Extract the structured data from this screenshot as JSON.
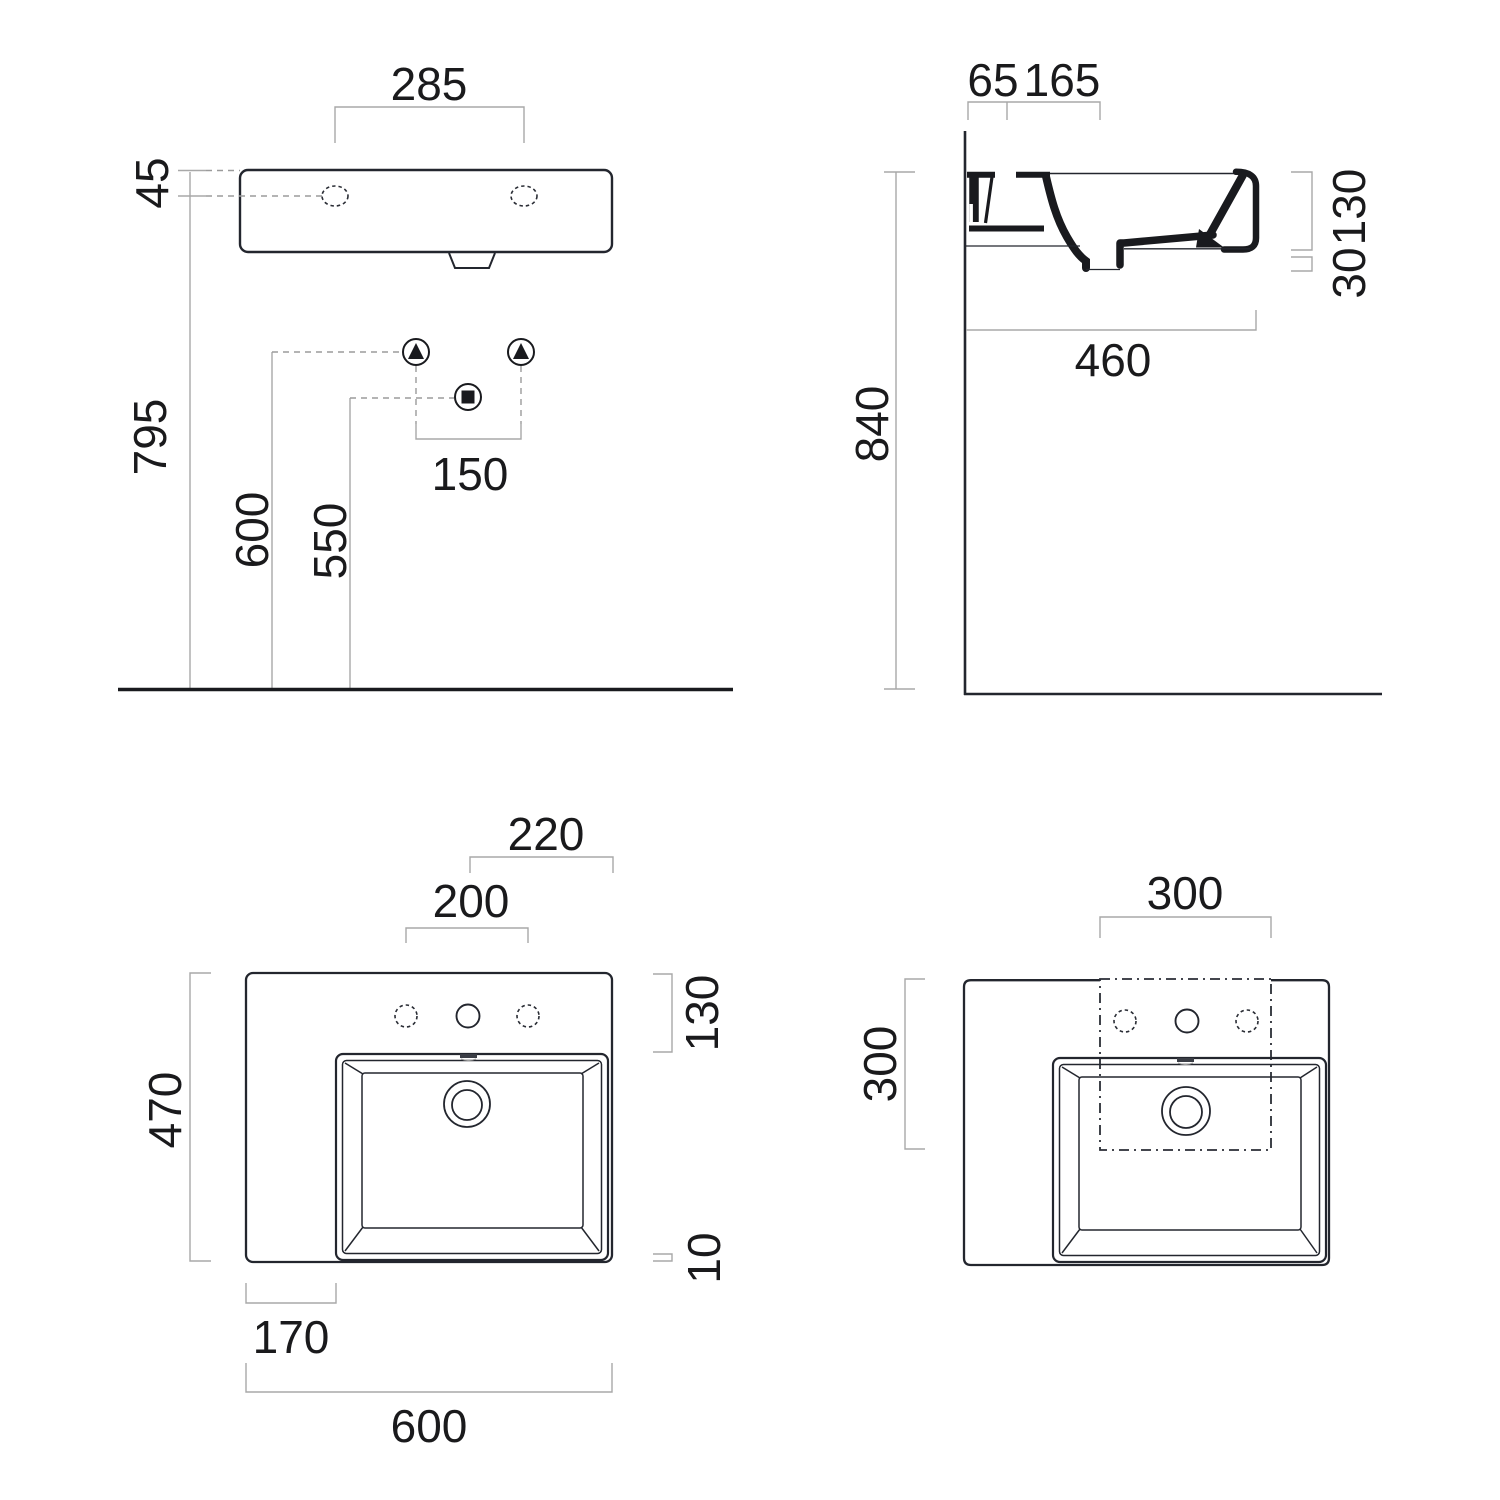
{
  "drawing": {
    "background": "#ffffff",
    "colors": {
      "object_line": "#23262e",
      "dimension_line": "#a8a8a8",
      "text": "#1a1a1c"
    },
    "views": {
      "front_elevation": {
        "dims": {
          "tap_centres": "285",
          "rim_to_tap": "45",
          "floor_to_rim": "795",
          "floor_to_supply": "600",
          "floor_to_waste": "550",
          "supply_centres": "150"
        }
      },
      "side_section": {
        "dims": {
          "wall_to_tap": "65",
          "tap_to_overflow": "165",
          "basin_height": "130",
          "outlet_drop": "30",
          "projection": "460",
          "floor_to_rim": "840"
        }
      },
      "plan": {
        "dims": {
          "tap_to_right_edge": "220",
          "tap_centres": "200",
          "deck_depth": "130",
          "overall_depth": "470",
          "front_rim": "10",
          "left_deck_width": "170",
          "overall_width": "600"
        }
      },
      "plan_cutout": {
        "dims": {
          "cutout_width": "300",
          "cutout_depth": "300"
        }
      }
    }
  }
}
